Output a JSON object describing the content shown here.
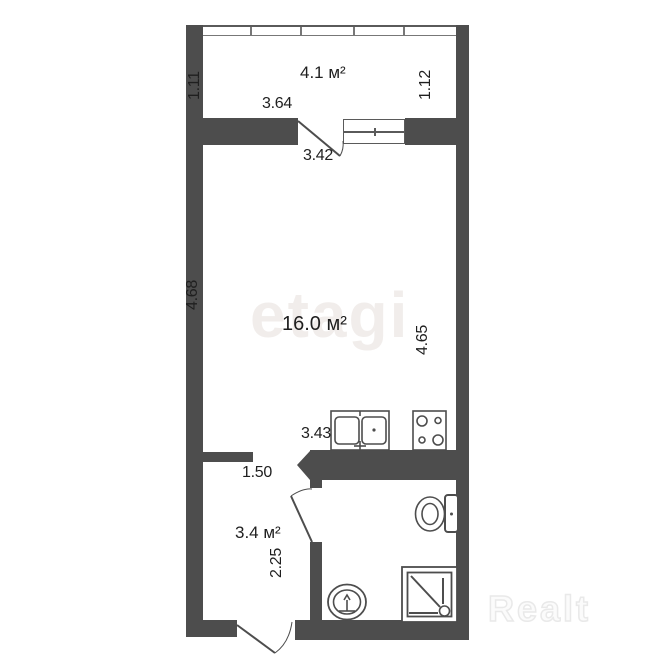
{
  "floorplan": {
    "balcony": {
      "area_label": "4.1 м²",
      "dim_left": "1.11",
      "dim_right": "1.12",
      "dim_width": "3.64",
      "door_width": "3.42"
    },
    "room": {
      "area_label": "16.0 м²",
      "dim_left": "4.68",
      "dim_right": "4.65",
      "dim_kitchen_wall": "3.43"
    },
    "hall": {
      "area_label": "3.4 м²",
      "dim_width": "1.50",
      "dim_bath_wall": "2.25"
    },
    "fixtures": [
      "kitchen-sink",
      "stove",
      "toilet",
      "shower-tray",
      "washbasin"
    ],
    "colors": {
      "wall": "#4d4d4d",
      "fixture_line": "#4d4d4d",
      "text": "#1f1f1f",
      "watermark_center": "#f1edeb",
      "watermark_corner_outline": "#e9e9e9"
    }
  },
  "watermarks": {
    "brand_center": "etagi",
    "brand_corner": "Realt"
  }
}
